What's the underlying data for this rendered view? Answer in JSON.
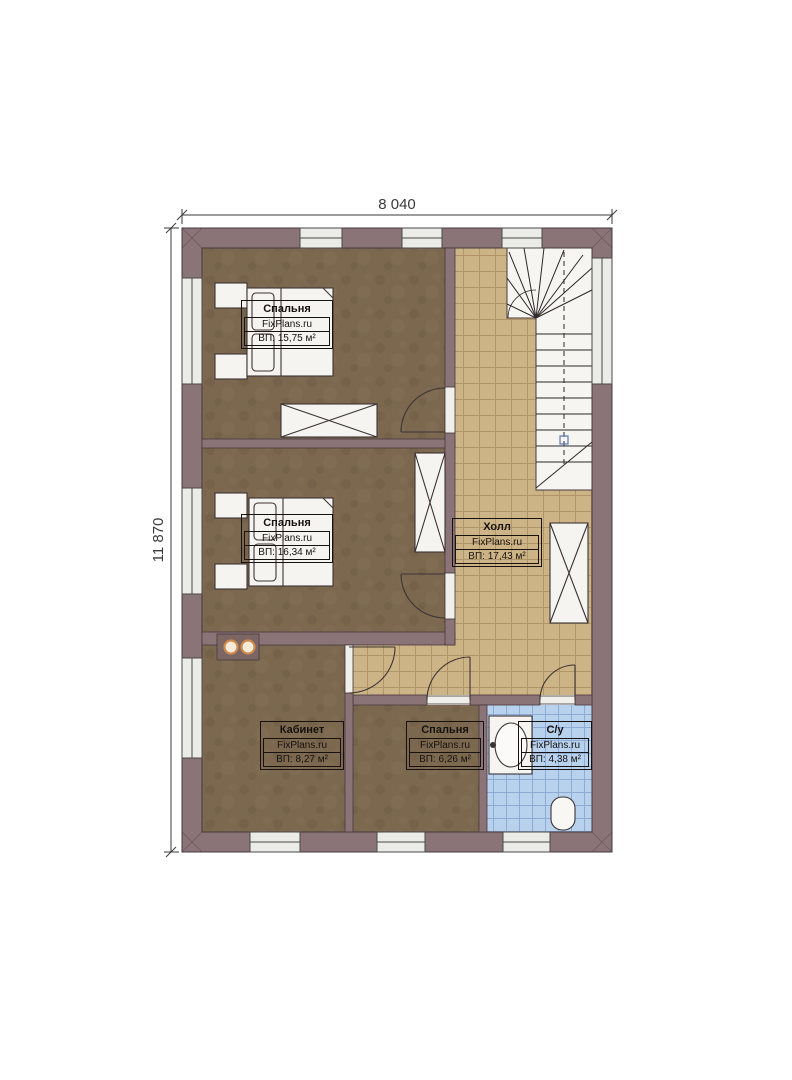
{
  "plan": {
    "brand_watermark": "FixPlans.ru",
    "kind": "floor plan"
  },
  "dimensions": {
    "width": "8 040",
    "height": "11 870"
  },
  "rooms": [
    {
      "name": "Спальня",
      "brand": "FixPlans.ru",
      "area": "ВП: 15,75 м²"
    },
    {
      "name": "Спальня",
      "brand": "FixPlans.ru",
      "area": "ВП: 16,34 м²"
    },
    {
      "name": "Холл",
      "brand": "FixPlans.ru",
      "area": "ВП: 17,43 м²"
    },
    {
      "name": "Кабинет",
      "brand": "FixPlans.ru",
      "area": "ВП: 8,27 м²"
    },
    {
      "name": "Спальня",
      "brand": "FixPlans.ru",
      "area": "ВП: 6,26 м²"
    },
    {
      "name": "С/у",
      "brand": "FixPlans.ru",
      "area": "ВП: 4,38 м²"
    }
  ],
  "colors": {
    "wall": "#8b7478",
    "bedroom_floor": "#7b684f",
    "hall_floor": "#cdb487",
    "bathroom_floor": "#b8d1ed",
    "stair_area": "#f6f5f1",
    "chimney_ring": "#cf8a4e"
  }
}
